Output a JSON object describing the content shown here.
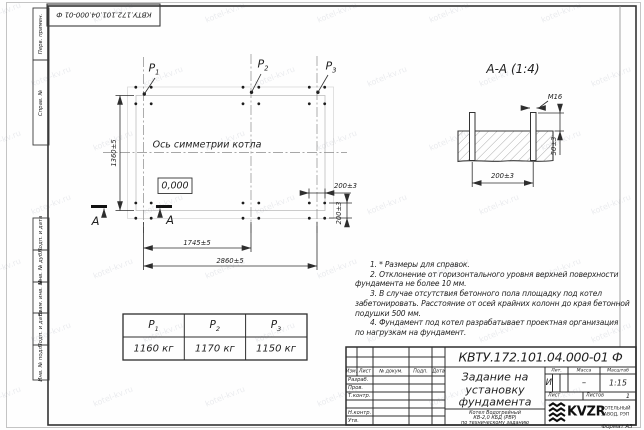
{
  "doc": {
    "number": "КВТУ.172.101.04.000-01 Ф"
  },
  "margin": {
    "labels": [
      "Перв. примен.",
      "Справ. №",
      "Подп. и дата",
      "Инв. № дубл.",
      "Взам. инв. №",
      "Подп. и дата",
      "Инв. № подл."
    ]
  },
  "plan": {
    "axis_label": "Ось симметрии котла",
    "elevation": "0,000",
    "section_letter": "А",
    "p_labels": [
      {
        "base": "Р",
        "sub": "1"
      },
      {
        "base": "Р",
        "sub": "2"
      },
      {
        "base": "Р",
        "sub": "3"
      }
    ],
    "dim_height": "1360±5",
    "dim_width_inner": "1745±5",
    "dim_width_outer": "2860±5",
    "dim_bolt_horizontal": "200±3",
    "dim_bolt_vertical": "200±3"
  },
  "section": {
    "title": "А-А (1:4)",
    "bolt_thread": "М16",
    "dim_protrusion": "50±3",
    "dim_spacing": "200±3"
  },
  "notes": {
    "lines": [
      "1. * Размеры для справок.",
      "2. Отклонение от горизонтального уровня верхней поверхности",
      "фундамента не более 10 мм.",
      "3. В случае отсутствия бетонного пола площадку под котел",
      "забетонировать. Расстояние от осей крайних колонн до края бетонной",
      "подушки 500 мм.",
      "4. Фундамент под котел разрабатывает проектная организация",
      "по нагрузкам на фундамент."
    ]
  },
  "load_table": {
    "headers": [
      {
        "base": "Р",
        "sub": "1"
      },
      {
        "base": "Р",
        "sub": "2"
      },
      {
        "base": "Р",
        "sub": "3"
      }
    ],
    "values": [
      "1160 кг",
      "1170 кг",
      "1150 кг"
    ]
  },
  "title_block": {
    "doc_number": "КВТУ.172.101.04.000-01 Ф",
    "title_lines": [
      "Задание на",
      "установку",
      "фундамента"
    ],
    "product_lines": [
      "Котел Водогрейный",
      "КВ-2,0 КБД (РВР)",
      "по техническому заданию"
    ],
    "sig_header": [
      "Изм.",
      "Лист",
      "№ докум.",
      "Подп.",
      "Дата"
    ],
    "sig_rows": [
      "Разраб.",
      "Пров.",
      "Т.контр.",
      "",
      "Н.контр.",
      "Утв."
    ],
    "lit_label": "Лит.",
    "mass_label": "Масса",
    "scale_label": "Масштаб",
    "lit_value": "И",
    "mass_value": "–",
    "scale_value": "1:15",
    "sheet_label": "Лист",
    "sheets_label": "Листов",
    "sheets_value": "1",
    "brand": "KVZR",
    "brand_sub1": "КОТЕЛЬНЫЙ",
    "brand_sub2": "ЗАВОД, РЭП",
    "format_label": "Формат А3"
  },
  "watermark": {
    "text": "kotel-kv.ru"
  }
}
